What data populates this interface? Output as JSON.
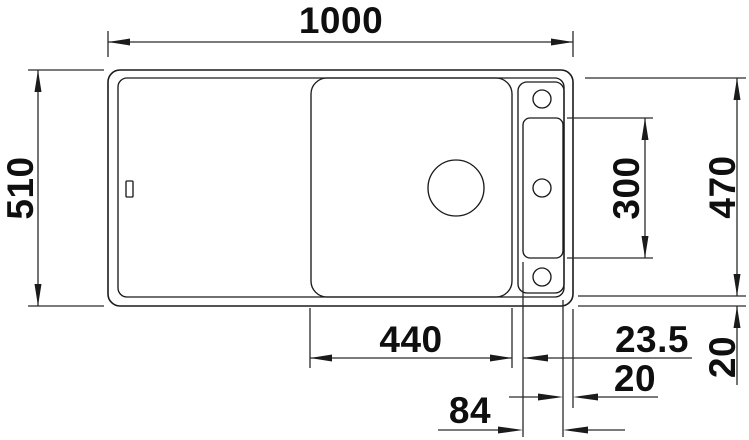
{
  "drawing": {
    "dims": {
      "overall_width": "1000",
      "overall_depth": "510",
      "right_depth": "470",
      "recess_length": "300",
      "bowl_width": "440",
      "bowl_to_recess": "23.5",
      "recess_to_right_edge": "20",
      "bottom_rim": "20",
      "recess_width": "84"
    },
    "colors": {
      "line": "#1b1b1b",
      "background": "#ffffff"
    }
  }
}
